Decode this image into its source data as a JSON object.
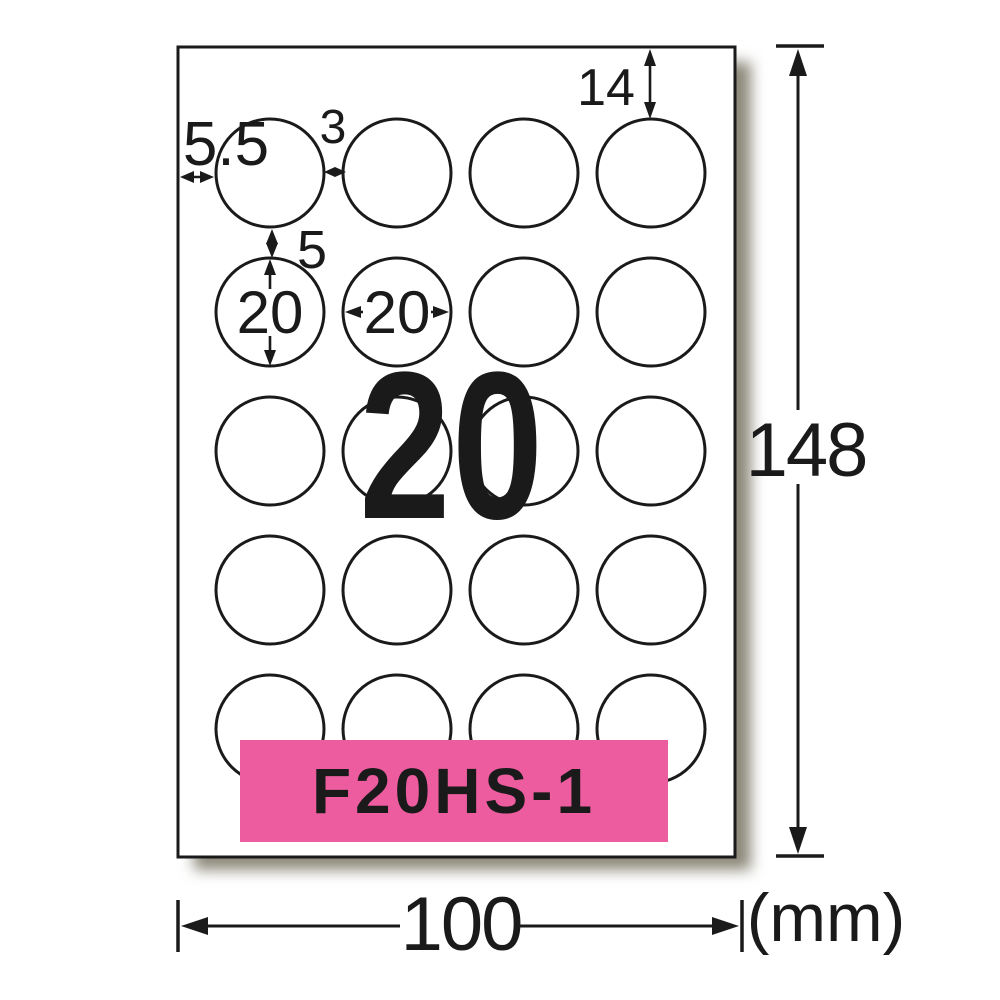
{
  "product": {
    "model": "F20HS-1",
    "watermark_count": "20"
  },
  "sheet": {
    "width_mm": "100",
    "height_mm": "148",
    "unit": "(mm)",
    "grid": {
      "rows": 5,
      "cols": 4,
      "total_labels": 20,
      "label_shape": "circle"
    },
    "dimensions": {
      "left_margin_mm": "5.5",
      "column_gap_mm": "3",
      "top_margin_mm": "14",
      "row_gap_mm": "5",
      "label_diameter_vertical_mm": "20",
      "label_diameter_horizontal_mm": "20"
    }
  },
  "colors": {
    "banner_pink": "#ec5c9e",
    "watermark_pink": "#f3aacb",
    "line_black": "#1a1a1a",
    "paper_white": "#ffffff",
    "shadow_gray": "#8c897a"
  }
}
